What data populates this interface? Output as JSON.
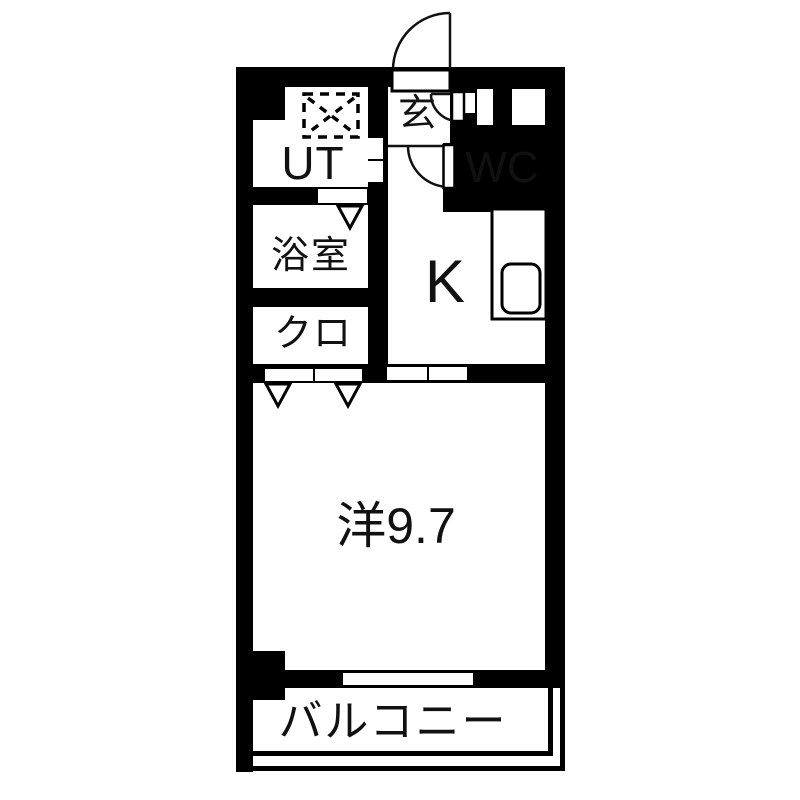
{
  "floorplan": {
    "type": "apartment-floor-plan",
    "rooms": {
      "entrance": {
        "label": "玄"
      },
      "utility": {
        "label": "UT"
      },
      "toilet": {
        "label": "WC"
      },
      "bathroom": {
        "label": "浴室"
      },
      "kitchen": {
        "label": "K"
      },
      "closet": {
        "label": "クロ"
      },
      "western_room": {
        "label": "洋9.7"
      },
      "balcony": {
        "label": "バルコニー"
      }
    },
    "fixtures": [
      "entrance-door-swing-arc",
      "hall-door-swing-arc",
      "wc-door-swing-arc",
      "washing-machine-pan-dashed-square",
      "kitchen-counter",
      "kitchen-sink",
      "fold-door-triangle-markers",
      "balcony-railing-double-line"
    ],
    "colors": {
      "wall": "#000000",
      "floor": "#ffffff",
      "line": "#111111"
    }
  }
}
